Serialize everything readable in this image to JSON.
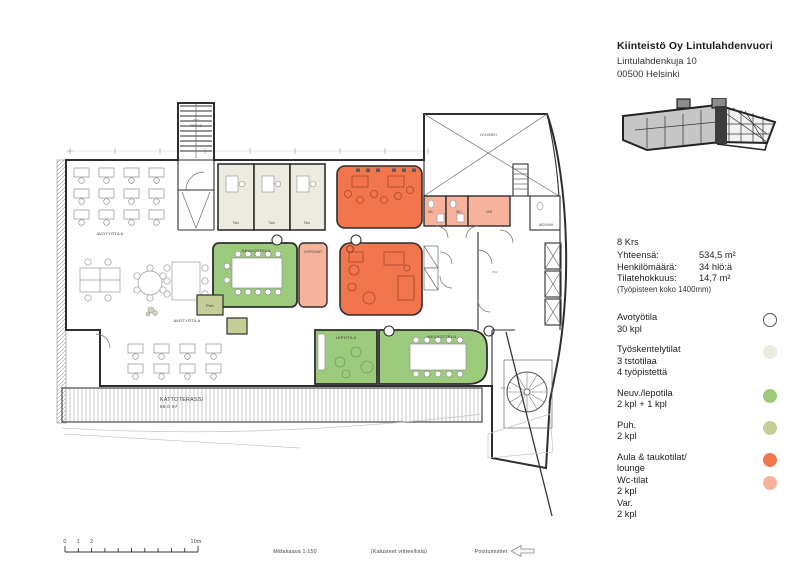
{
  "header": {
    "company": "Kiinteistö Oy Lintulahdenvuori",
    "address_line1": "Lintulahdenkuja 10",
    "address_line2": "00500 Helsinki"
  },
  "stats": {
    "floor": "8 Krs",
    "rows": [
      {
        "label": "Yhteensä:",
        "value": "534,5 m²"
      },
      {
        "label": "Henkilömäärä:",
        "value": "34 hlö:ä"
      },
      {
        "label": "Tilatehokkuus:",
        "value": "14,7 m²"
      }
    ],
    "note": "(Työpisteen koko 1400mm)"
  },
  "legend": {
    "items": [
      {
        "title": "Avotyötila",
        "lines": [
          "30 kpl"
        ],
        "swatch": "open"
      },
      {
        "title": "Työskentelytilat",
        "lines": [
          "3 tstotilaa",
          "4 työpistettä"
        ],
        "swatch": "office"
      },
      {
        "title": "Neuv./lepotila",
        "lines": [
          "2 kpl + 1 kpl"
        ],
        "swatch": "meeting"
      },
      {
        "title": "Puh.",
        "lines": [
          "2 kpl"
        ],
        "swatch": "phone"
      },
      {
        "title": "Aula & taukotilat/",
        "lines": [
          "lounge"
        ],
        "swatch": "lounge"
      },
      {
        "title": "Wc-tilat",
        "lines": [
          "2 kpl"
        ],
        "swatch": "wc"
      },
      {
        "title": "Var.",
        "lines": [
          "2 kpl"
        ],
        "swatch": "none"
      }
    ]
  },
  "plan": {
    "labels": {
      "stair_b_num": "803",
      "stair_b": "PR H B",
      "avotyotila_top": "AVOTYÖTILA",
      "tsto": "Tsto",
      "iv": "IV-KONEH.",
      "wc": "WC",
      "var": "VAR",
      "wc_inva": "WC/INVA",
      "neuvottelu": "NEUVOTTELU",
      "kopio": "KOPIO/VAR",
      "avotyotila_mid": "AVOTYÖTILA",
      "puh": "Puh",
      "lepotila": "LEPOTILA",
      "neuvottelu2": "NEUVOTTELU",
      "terrace": "KATTOTERASSI",
      "terrace_area": "88,0 m²",
      "stair_a": "PR H A",
      "room_num": "802"
    }
  },
  "footer": {
    "tick0": "0",
    "tick1": "1",
    "tick2": "2",
    "tick10": "10m",
    "scale": "Mittakaava 1:150",
    "furniture_note": "(Kalusteet viitteellisiä)",
    "exits": "Poistumistiet"
  },
  "colors": {
    "lounge": "#F1764D",
    "wc": "#F7B29B",
    "meeting": "#9CCB7D",
    "phone": "#C6CD97",
    "office": "#EDEADF",
    "open": "#FFFFFF"
  }
}
